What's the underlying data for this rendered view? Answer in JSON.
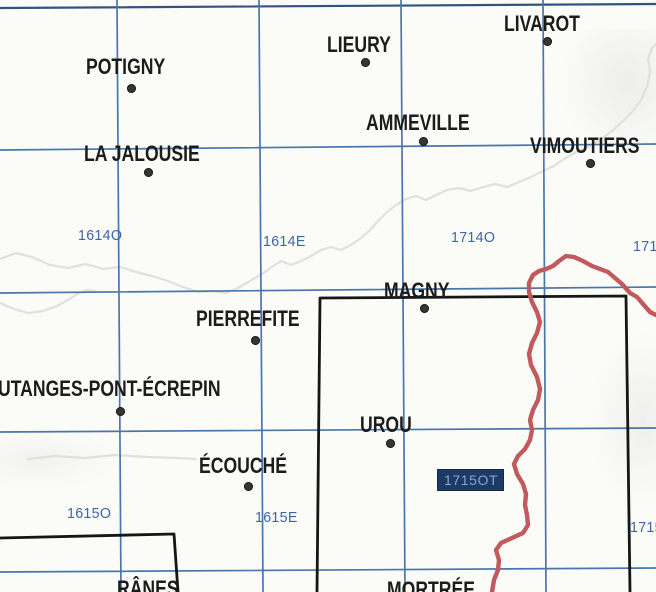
{
  "canvas": {
    "width": 656,
    "height": 592,
    "background": "#fbfbf8"
  },
  "colors": {
    "grid": "#4a76ac",
    "grid_dark": "#33547f",
    "town_text": "#1c1c1c",
    "sheet_label_text": "#3f64a9",
    "boundary_red": "#c05a5d",
    "river_gray": "#e2e0db",
    "outline_black": "#161616",
    "highlight_bg": "#1d3a63",
    "highlight_fg": "#87a4d0",
    "highlight_border": "#10294d"
  },
  "towns": [
    {
      "name": "POTIGNY",
      "dot": {
        "x": 131,
        "y": 88
      },
      "label": {
        "x": 86,
        "y": 56
      }
    },
    {
      "name": "LIEURY",
      "dot": {
        "x": 365,
        "y": 62
      },
      "label": {
        "x": 327,
        "y": 34
      }
    },
    {
      "name": "LIVAROT",
      "dot": {
        "x": 547,
        "y": 41
      },
      "label": {
        "x": 504,
        "y": 13
      }
    },
    {
      "name": "AMMEVILLE",
      "dot": {
        "x": 423,
        "y": 141
      },
      "label": {
        "x": 366,
        "y": 112
      }
    },
    {
      "name": "VIMOUTIERS",
      "dot": {
        "x": 590,
        "y": 163
      },
      "label": {
        "x": 530,
        "y": 135
      }
    },
    {
      "name": "LA JALOUSIE",
      "dot": {
        "x": 148,
        "y": 172
      },
      "label": {
        "x": 84,
        "y": 143
      }
    },
    {
      "name": "MAGNY",
      "dot": {
        "x": 424,
        "y": 308
      },
      "label": {
        "x": 384,
        "y": 280
      }
    },
    {
      "name": "PIERREFITE",
      "dot": {
        "x": 255,
        "y": 340
      },
      "label": {
        "x": 196,
        "y": 308
      }
    },
    {
      "name": "UTANGES-PONT-ÉCREPIN",
      "dot": {
        "x": 120,
        "y": 411
      },
      "label": {
        "x": -2,
        "y": 378
      }
    },
    {
      "name": "UROU",
      "dot": {
        "x": 390,
        "y": 443
      },
      "label": {
        "x": 360,
        "y": 414
      }
    },
    {
      "name": "ÉCOUCHÉ",
      "dot": {
        "x": 248,
        "y": 486
      },
      "label": {
        "x": 199,
        "y": 455
      }
    },
    {
      "name": "RÂNES",
      "dot": null,
      "label": {
        "x": 117,
        "y": 578
      }
    },
    {
      "name": "MORTRÉE",
      "dot": null,
      "label": {
        "x": 387,
        "y": 579
      }
    }
  ],
  "sheet_labels": [
    {
      "text": "1614O",
      "x": 78,
      "y": 228
    },
    {
      "text": "1614E",
      "x": 263,
      "y": 234
    },
    {
      "text": "1714O",
      "x": 451,
      "y": 230
    },
    {
      "text": "1714E",
      "x": 633,
      "y": 239
    },
    {
      "text": "1615O",
      "x": 67,
      "y": 506
    },
    {
      "text": "1615E",
      "x": 255,
      "y": 510
    },
    {
      "text": "1715E",
      "x": 630,
      "y": 520
    }
  ],
  "highlighted_sheet": {
    "text": "1715OT",
    "x": 437,
    "y": 469
  },
  "grid_lines": [
    {
      "points": [
        [
          0,
          8
        ],
        [
          656,
          4
        ]
      ],
      "dark": true,
      "width": 2.2
    },
    {
      "points": [
        [
          0,
          150
        ],
        [
          656,
          144
        ]
      ]
    },
    {
      "points": [
        [
          0,
          293
        ],
        [
          656,
          287
        ]
      ]
    },
    {
      "points": [
        [
          0,
          432
        ],
        [
          656,
          428
        ]
      ]
    },
    {
      "points": [
        [
          0,
          572
        ],
        [
          656,
          568
        ]
      ]
    },
    {
      "points": [
        [
          117,
          0
        ],
        [
          121,
          592
        ]
      ]
    },
    {
      "points": [
        [
          259,
          0
        ],
        [
          263,
          592
        ]
      ]
    },
    {
      "points": [
        [
          401,
          0
        ],
        [
          405,
          592
        ]
      ]
    },
    {
      "points": [
        [
          543,
          0
        ],
        [
          546,
          592
        ]
      ]
    }
  ],
  "sheet_outlines": [
    {
      "points": [
        [
          317,
          592
        ],
        [
          320,
          298
        ],
        [
          626,
          296
        ],
        [
          630,
          592
        ]
      ]
    },
    {
      "points": [
        [
          0,
          538
        ],
        [
          174,
          534
        ],
        [
          178,
          592
        ]
      ]
    }
  ],
  "boundary": {
    "points": [
      [
        656,
        315
      ],
      [
        650,
        312
      ],
      [
        643,
        304
      ],
      [
        637,
        297
      ],
      [
        630,
        293
      ],
      [
        622,
        284
      ],
      [
        615,
        278
      ],
      [
        608,
        272
      ],
      [
        600,
        269
      ],
      [
        592,
        266
      ],
      [
        583,
        261
      ],
      [
        574,
        257
      ],
      [
        566,
        256
      ],
      [
        559,
        261
      ],
      [
        553,
        266
      ],
      [
        546,
        269
      ],
      [
        539,
        271
      ],
      [
        533,
        275
      ],
      [
        529,
        283
      ],
      [
        529,
        292
      ],
      [
        532,
        302
      ],
      [
        537,
        312
      ],
      [
        540,
        322
      ],
      [
        537,
        333
      ],
      [
        532,
        343
      ],
      [
        529,
        354
      ],
      [
        531,
        365
      ],
      [
        537,
        377
      ],
      [
        540,
        389
      ],
      [
        538,
        400
      ],
      [
        533,
        410
      ],
      [
        530,
        420
      ],
      [
        532,
        430
      ],
      [
        530,
        440
      ],
      [
        525,
        449
      ],
      [
        518,
        456
      ],
      [
        514,
        464
      ],
      [
        517,
        474
      ],
      [
        523,
        484
      ],
      [
        526,
        494
      ],
      [
        525,
        505
      ],
      [
        527,
        515
      ],
      [
        528,
        525
      ],
      [
        523,
        533
      ],
      [
        512,
        538
      ],
      [
        501,
        543
      ],
      [
        496,
        550
      ],
      [
        499,
        560
      ],
      [
        498,
        570
      ],
      [
        494,
        580
      ],
      [
        492,
        592
      ]
    ]
  },
  "rivers": [
    {
      "points": [
        [
          0,
          259
        ],
        [
          16,
          253
        ],
        [
          32,
          257
        ],
        [
          50,
          265
        ],
        [
          68,
          268
        ],
        [
          86,
          264
        ],
        [
          103,
          269
        ],
        [
          120,
          267
        ],
        [
          136,
          272
        ],
        [
          152,
          276
        ],
        [
          168,
          281
        ],
        [
          183,
          287
        ],
        [
          198,
          292
        ],
        [
          212,
          291
        ],
        [
          226,
          293
        ],
        [
          238,
          288
        ],
        [
          250,
          281
        ],
        [
          262,
          274
        ],
        [
          272,
          267
        ],
        [
          281,
          261
        ],
        [
          291,
          265
        ],
        [
          301,
          261
        ],
        [
          311,
          256
        ],
        [
          321,
          250
        ],
        [
          331,
          247
        ],
        [
          341,
          250
        ],
        [
          351,
          245
        ],
        [
          361,
          238
        ],
        [
          370,
          230
        ],
        [
          378,
          221
        ],
        [
          387,
          212
        ],
        [
          396,
          205
        ],
        [
          406,
          199
        ],
        [
          416,
          196
        ],
        [
          426,
          200
        ],
        [
          436,
          195
        ],
        [
          447,
          190
        ],
        [
          459,
          188
        ],
        [
          471,
          191
        ],
        [
          483,
          187
        ],
        [
          495,
          184
        ],
        [
          507,
          187
        ],
        [
          519,
          182
        ],
        [
          531,
          177
        ],
        [
          543,
          171
        ],
        [
          554,
          166
        ],
        [
          564,
          159
        ],
        [
          576,
          152
        ],
        [
          588,
          147
        ],
        [
          600,
          140
        ],
        [
          612,
          131
        ],
        [
          623,
          121
        ],
        [
          633,
          111
        ],
        [
          641,
          100
        ],
        [
          647,
          87
        ],
        [
          650,
          72
        ],
        [
          648,
          59
        ],
        [
          652,
          48
        ],
        [
          656,
          44
        ]
      ]
    },
    {
      "points": [
        [
          0,
          303
        ],
        [
          14,
          309
        ],
        [
          28,
          313
        ],
        [
          43,
          311
        ],
        [
          57,
          306
        ],
        [
          68,
          300
        ],
        [
          77,
          294
        ],
        [
          86,
          290
        ],
        [
          95,
          291
        ]
      ]
    },
    {
      "points": [
        [
          28,
          459
        ],
        [
          55,
          456
        ],
        [
          85,
          458
        ],
        [
          115,
          455
        ],
        [
          148,
          457
        ],
        [
          178,
          458
        ],
        [
          196,
          459
        ]
      ]
    }
  ]
}
